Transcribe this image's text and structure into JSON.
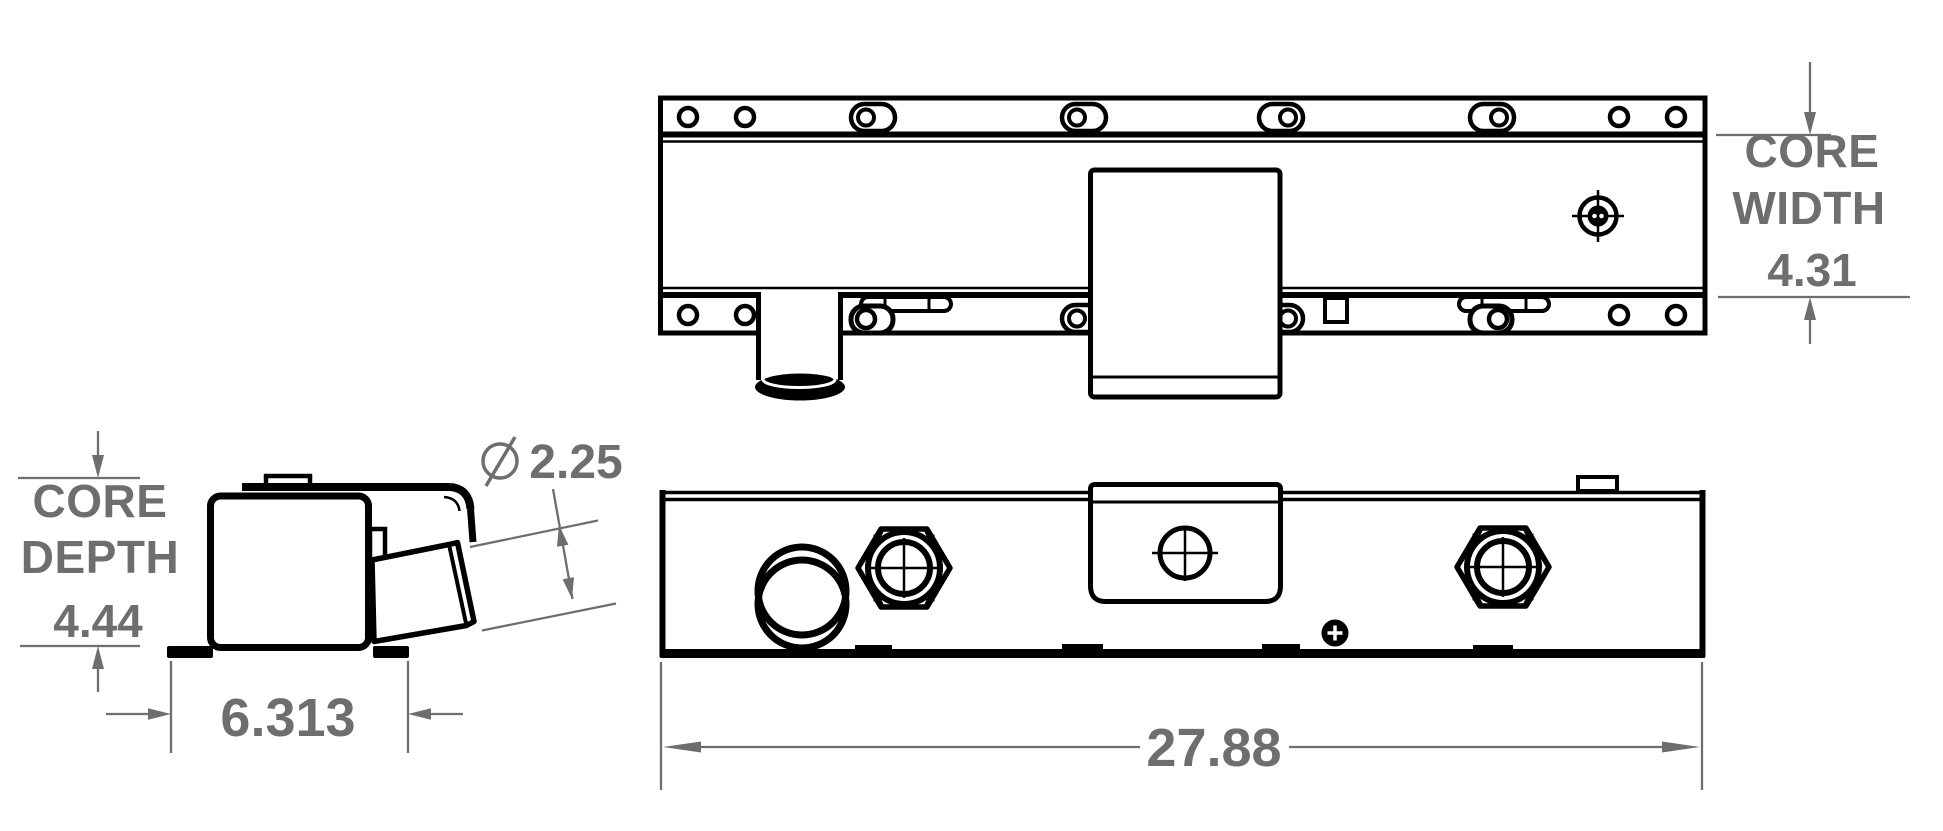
{
  "colors": {
    "ink": "#000000",
    "dimension": "#6e6e6e",
    "background": "#ffffff"
  },
  "dimensions": {
    "core_width": {
      "line1": "CORE",
      "line2": "WIDTH",
      "value": "4.31"
    },
    "core_depth": {
      "line1": "CORE",
      "line2": "DEPTH",
      "value": "4.44"
    },
    "outlet_diameter": {
      "symbol": "Ø",
      "value": "2.25"
    },
    "mounting_width": {
      "value": "6.313"
    },
    "overall_length": {
      "value": "27.88"
    }
  }
}
